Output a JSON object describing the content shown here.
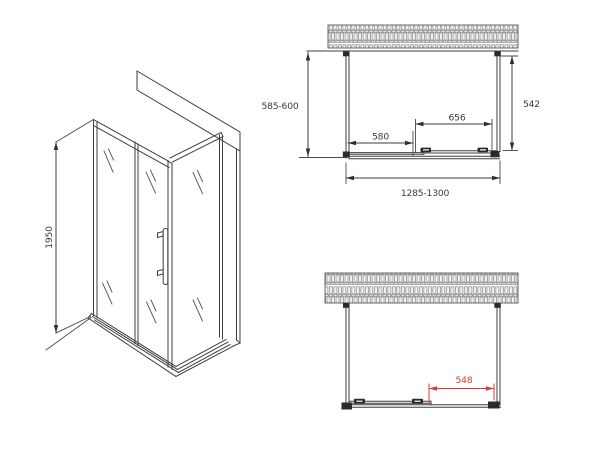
{
  "page": {
    "background": "#ffffff"
  },
  "drawing": {
    "type": "technical-drawing",
    "subject": "shower-enclosure-with-sliding-door",
    "line_color": "#3d3d3d",
    "accent_color": "#e03636",
    "hatch_color": "#8a8a8a",
    "views": {
      "isometric": {
        "title": "isometric-view",
        "dimensions": {
          "height": {
            "label": "1950"
          }
        }
      },
      "plan_closed": {
        "title": "top-view-door-closed",
        "dimensions": {
          "depth_left": {
            "label": "585-600"
          },
          "depth_right": {
            "label": "542"
          },
          "door_glass": {
            "label": "656"
          },
          "fixed_glass": {
            "label": "580"
          },
          "overall_width": {
            "label": "1285-1300"
          }
        }
      },
      "plan_open": {
        "title": "top-view-door-open",
        "dimensions": {
          "opening": {
            "label": "548",
            "color": "#e03636"
          }
        }
      }
    }
  }
}
